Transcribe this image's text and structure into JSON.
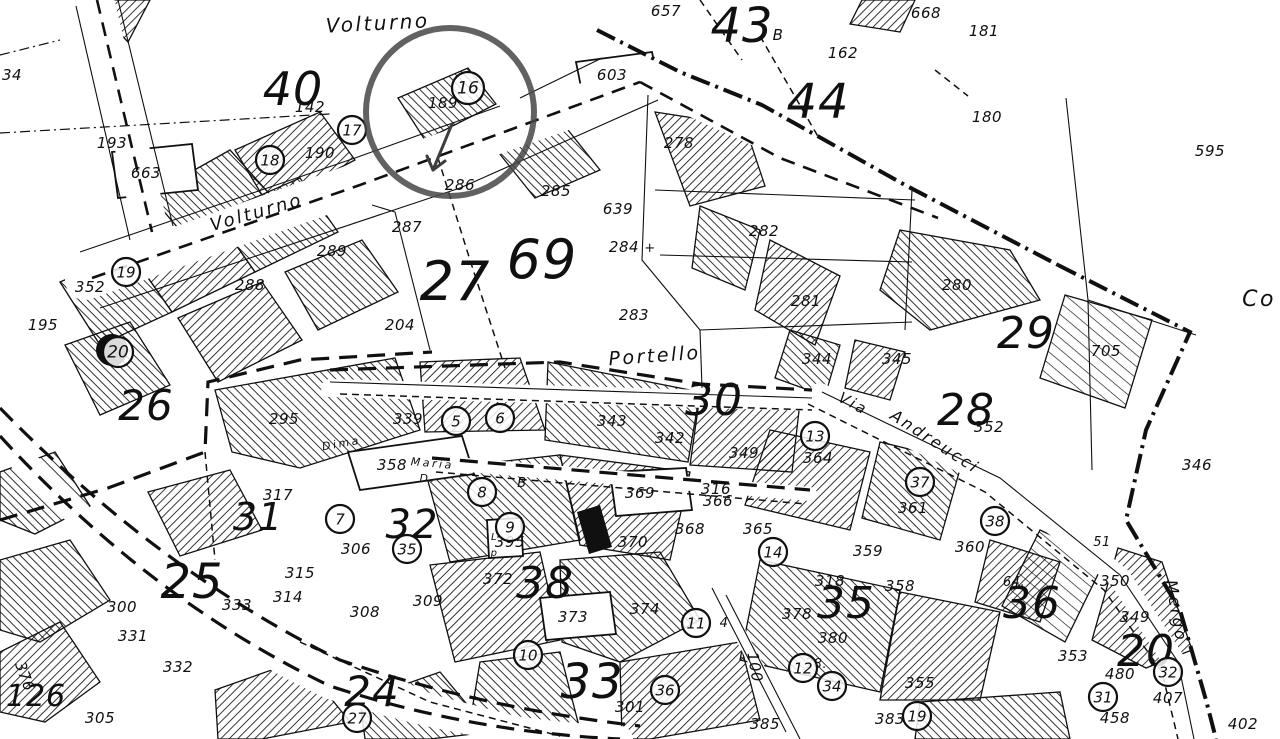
{
  "map": {
    "colors": {
      "ink": "#101010",
      "paper": "#ffffff",
      "annotation": "#474747"
    },
    "annotation": {
      "kind": "highlight-circle",
      "cx": 450,
      "cy": 112,
      "r": 84,
      "target": "16"
    },
    "streets": [
      {
        "t": "Volturno",
        "x": 378,
        "y": 30,
        "r": -3,
        "s": 20
      },
      {
        "t": "Volturno",
        "x": 258,
        "y": 218,
        "r": -16,
        "s": 18
      },
      {
        "t": "Portello",
        "x": 655,
        "y": 362,
        "r": -4,
        "s": 19
      },
      {
        "t": "Via",
        "x": 851,
        "y": 408,
        "r": 28,
        "s": 15
      },
      {
        "t": "Andreucci",
        "x": 932,
        "y": 446,
        "r": 33,
        "s": 16
      },
      {
        "t": "Mergo",
        "x": 1171,
        "y": 612,
        "r": 80,
        "s": 16
      },
      {
        "t": "Maria",
        "x": 432,
        "y": 467,
        "r": 5,
        "s": 11
      },
      {
        "t": "D.",
        "x": 428,
        "y": 482,
        "r": 0,
        "s": 11
      },
      {
        "t": "Dima",
        "x": 342,
        "y": 447,
        "r": -10,
        "s": 11
      },
      {
        "t": "Co",
        "x": 1259,
        "y": 306,
        "r": 0,
        "s": 22
      }
    ],
    "zone_numbers": [
      {
        "t": "40",
        "x": 293,
        "y": 105,
        "s": 46
      },
      {
        "t": "43",
        "x": 742,
        "y": 42,
        "s": 48
      },
      {
        "t": "44",
        "x": 818,
        "y": 118,
        "s": 48
      },
      {
        "t": "27",
        "x": 455,
        "y": 300,
        "s": 54
      },
      {
        "t": "69",
        "x": 542,
        "y": 278,
        "s": 54
      },
      {
        "t": "26",
        "x": 146,
        "y": 420,
        "s": 42
      },
      {
        "t": "25",
        "x": 192,
        "y": 598,
        "s": 48
      },
      {
        "t": "29",
        "x": 1026,
        "y": 348,
        "s": 44
      },
      {
        "t": "28",
        "x": 966,
        "y": 425,
        "s": 44
      },
      {
        "t": "30",
        "x": 714,
        "y": 415,
        "s": 44
      },
      {
        "t": "31",
        "x": 258,
        "y": 530,
        "s": 38
      },
      {
        "t": "32",
        "x": 412,
        "y": 538,
        "s": 40
      },
      {
        "t": "38",
        "x": 545,
        "y": 598,
        "s": 44
      },
      {
        "t": "33",
        "x": 592,
        "y": 698,
        "s": 48
      },
      {
        "t": "35",
        "x": 846,
        "y": 618,
        "s": 44
      },
      {
        "t": "36",
        "x": 1032,
        "y": 618,
        "s": 44
      },
      {
        "t": "24",
        "x": 372,
        "y": 706,
        "s": 42
      },
      {
        "t": "20",
        "x": 1146,
        "y": 666,
        "s": 44
      },
      {
        "t": "126",
        "x": 36,
        "y": 706,
        "s": 30
      }
    ],
    "parcel_numbers": [
      {
        "t": "142",
        "x": 310,
        "y": 112
      },
      {
        "t": "193",
        "x": 112,
        "y": 148
      },
      {
        "t": "663",
        "x": 146,
        "y": 178
      },
      {
        "t": "34",
        "x": 12,
        "y": 80
      },
      {
        "t": "657",
        "x": 666,
        "y": 16
      },
      {
        "t": "603",
        "x": 612,
        "y": 80
      },
      {
        "t": "668",
        "x": 926,
        "y": 18
      },
      {
        "t": "181",
        "x": 984,
        "y": 36
      },
      {
        "t": "162",
        "x": 843,
        "y": 58
      },
      {
        "t": "180",
        "x": 987,
        "y": 122
      },
      {
        "t": "595",
        "x": 1210,
        "y": 156
      },
      {
        "t": "B",
        "x": 778,
        "y": 40
      },
      {
        "t": "189",
        "x": 443,
        "y": 108
      },
      {
        "t": "190",
        "x": 320,
        "y": 158
      },
      {
        "t": "195",
        "x": 43,
        "y": 330
      },
      {
        "t": "352",
        "x": 90,
        "y": 292
      },
      {
        "t": "288",
        "x": 250,
        "y": 290
      },
      {
        "t": "289",
        "x": 332,
        "y": 256
      },
      {
        "t": "286",
        "x": 460,
        "y": 190
      },
      {
        "t": "287",
        "x": 407,
        "y": 232
      },
      {
        "t": "285",
        "x": 556,
        "y": 196
      },
      {
        "t": "639",
        "x": 618,
        "y": 214
      },
      {
        "t": "284",
        "x": 624,
        "y": 252
      },
      {
        "t": "+",
        "x": 650,
        "y": 252,
        "s": 13
      },
      {
        "t": "283",
        "x": 634,
        "y": 320
      },
      {
        "t": "204",
        "x": 400,
        "y": 330
      },
      {
        "t": "278",
        "x": 679,
        "y": 148
      },
      {
        "t": "282",
        "x": 764,
        "y": 236
      },
      {
        "t": "281",
        "x": 806,
        "y": 306
      },
      {
        "t": "280",
        "x": 957,
        "y": 290
      },
      {
        "t": "705",
        "x": 1106,
        "y": 356
      },
      {
        "t": "352",
        "x": 989,
        "y": 432
      },
      {
        "t": "346",
        "x": 1197,
        "y": 470
      },
      {
        "t": "344",
        "x": 817,
        "y": 364
      },
      {
        "t": "345",
        "x": 897,
        "y": 364
      },
      {
        "t": "295",
        "x": 284,
        "y": 424
      },
      {
        "t": "339",
        "x": 408,
        "y": 424
      },
      {
        "t": "343",
        "x": 612,
        "y": 426
      },
      {
        "t": "342",
        "x": 670,
        "y": 443
      },
      {
        "t": "349",
        "x": 744,
        "y": 458
      },
      {
        "t": "364",
        "x": 818,
        "y": 463
      },
      {
        "t": "358",
        "x": 392,
        "y": 470
      },
      {
        "t": "317",
        "x": 278,
        "y": 500
      },
      {
        "t": "306",
        "x": 356,
        "y": 554
      },
      {
        "t": "315",
        "x": 300,
        "y": 578
      },
      {
        "t": "314",
        "x": 288,
        "y": 602
      },
      {
        "t": "308",
        "x": 365,
        "y": 617
      },
      {
        "t": "309",
        "x": 428,
        "y": 606
      },
      {
        "t": "395",
        "x": 510,
        "y": 547
      },
      {
        "t": "372",
        "x": 498,
        "y": 584
      },
      {
        "t": "373",
        "x": 573,
        "y": 622
      },
      {
        "t": "374",
        "x": 645,
        "y": 614
      },
      {
        "t": "370",
        "x": 633,
        "y": 547
      },
      {
        "t": "369",
        "x": 640,
        "y": 498
      },
      {
        "t": "368",
        "x": 690,
        "y": 534
      },
      {
        "t": "366",
        "x": 718,
        "y": 506
      },
      {
        "t": "365",
        "x": 758,
        "y": 534
      },
      {
        "t": "316",
        "x": 716,
        "y": 494
      },
      {
        "t": "4",
        "x": 724,
        "y": 627,
        "s": 13
      },
      {
        "t": "301",
        "x": 630,
        "y": 712
      },
      {
        "t": "100",
        "x": 750,
        "y": 668,
        "r": 80
      },
      {
        "t": "385",
        "x": 765,
        "y": 729
      },
      {
        "t": "378",
        "x": 797,
        "y": 619
      },
      {
        "t": "380",
        "x": 833,
        "y": 643
      },
      {
        "t": "38.",
        "x": 816,
        "y": 668,
        "s": 13
      },
      {
        "t": "355",
        "x": 920,
        "y": 688
      },
      {
        "t": "383",
        "x": 890,
        "y": 724
      },
      {
        "t": "359",
        "x": 868,
        "y": 556
      },
      {
        "t": "358",
        "x": 900,
        "y": 591
      },
      {
        "t": "361",
        "x": 913,
        "y": 513
      },
      {
        "t": "360",
        "x": 970,
        "y": 552
      },
      {
        "t": "64.",
        "x": 1014,
        "y": 586,
        "s": 13
      },
      {
        "t": "350",
        "x": 1115,
        "y": 586
      },
      {
        "t": "51",
        "x": 1102,
        "y": 546,
        "s": 13
      },
      {
        "t": "349",
        "x": 1135,
        "y": 622
      },
      {
        "t": "353",
        "x": 1073,
        "y": 661
      },
      {
        "t": "480",
        "x": 1120,
        "y": 679
      },
      {
        "t": "407",
        "x": 1168,
        "y": 703
      },
      {
        "t": "458",
        "x": 1115,
        "y": 723
      },
      {
        "t": "402",
        "x": 1243,
        "y": 729
      },
      {
        "t": "333",
        "x": 237,
        "y": 610
      },
      {
        "t": "300",
        "x": 122,
        "y": 612
      },
      {
        "t": "331",
        "x": 133,
        "y": 641
      },
      {
        "t": "332",
        "x": 178,
        "y": 672
      },
      {
        "t": "376",
        "x": 20,
        "y": 678,
        "r": 70
      },
      {
        "t": "305",
        "x": 100,
        "y": 723
      },
      {
        "t": "318",
        "x": 830,
        "y": 586
      },
      {
        "t": "B",
        "x": 522,
        "y": 487,
        "s": 13
      },
      {
        "t": "L",
        "x": 494,
        "y": 540,
        "s": 10
      },
      {
        "t": "p",
        "x": 494,
        "y": 556,
        "s": 10
      }
    ],
    "circled_markers": [
      {
        "t": "16",
        "x": 468,
        "y": 88,
        "cr": 16
      },
      {
        "t": "17",
        "x": 352,
        "y": 130
      },
      {
        "t": "18",
        "x": 270,
        "y": 160
      },
      {
        "t": "19",
        "x": 126,
        "y": 272
      },
      {
        "t": "20",
        "x": 118,
        "y": 352,
        "cr": 15
      },
      {
        "t": "5",
        "x": 456,
        "y": 421
      },
      {
        "t": "6",
        "x": 500,
        "y": 418
      },
      {
        "t": "7",
        "x": 340,
        "y": 519
      },
      {
        "t": "8",
        "x": 482,
        "y": 492
      },
      {
        "t": "9",
        "x": 510,
        "y": 527
      },
      {
        "t": "35",
        "x": 407,
        "y": 549
      },
      {
        "t": "13",
        "x": 815,
        "y": 436
      },
      {
        "t": "14",
        "x": 773,
        "y": 552
      },
      {
        "t": "11",
        "x": 696,
        "y": 623
      },
      {
        "t": "10",
        "x": 528,
        "y": 655
      },
      {
        "t": "27",
        "x": 357,
        "y": 718
      },
      {
        "t": "36",
        "x": 665,
        "y": 690
      },
      {
        "t": "12",
        "x": 803,
        "y": 668
      },
      {
        "t": "34",
        "x": 832,
        "y": 686
      },
      {
        "t": "19",
        "x": 917,
        "y": 716
      },
      {
        "t": "37",
        "x": 920,
        "y": 482
      },
      {
        "t": "38",
        "x": 995,
        "y": 521
      },
      {
        "t": "32",
        "x": 1168,
        "y": 672
      },
      {
        "t": "31",
        "x": 1103,
        "y": 697
      }
    ]
  }
}
